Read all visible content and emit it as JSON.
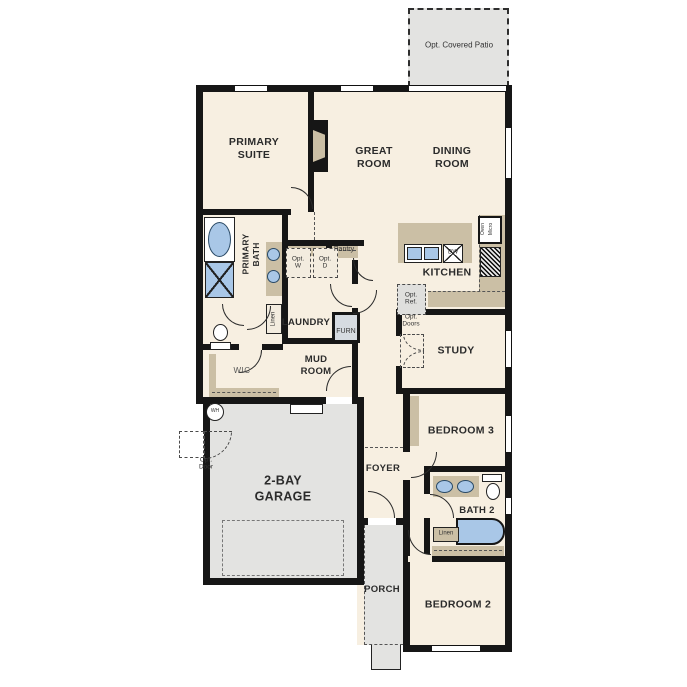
{
  "plan_title": "Single-story floor plan",
  "colors": {
    "floor": "#f7efe1",
    "concrete": "#e3e3e1",
    "cabinet": "#cbbfa5",
    "fixture_blue": "#a9c7e7",
    "wall": "#161616"
  },
  "rooms": {
    "patio": "Opt. Covered Patio",
    "primary_suite": "PRIMARY\nSUITE",
    "great_room": "GREAT\nROOM",
    "dining_room": "DINING\nROOM",
    "primary_bath": "PRIMARY\nBATH",
    "kitchen": "KITCHEN",
    "laundry": "LAUNDRY",
    "mud_room": "MUD\nROOM",
    "wic": "WIC",
    "study": "STUDY",
    "foyer": "FOYER",
    "bedroom3": "BEDROOM 3",
    "bath2": "BATH 2",
    "bedroom2": "BEDROOM 2",
    "garage": "2-BAY\nGARAGE",
    "porch": "PORCH"
  },
  "fixtures": {
    "pantry": "Pantry",
    "furnace": "FURN",
    "linen_primary": "Linen",
    "linen_bath2": "Linen",
    "opt_washer": "Opt.\nW",
    "opt_dryer": "Opt.\nD",
    "opt_ref": "Opt.\nRef.",
    "opt_doors": "Opt.\nDoors",
    "opt_door": "Opt.\nDoor",
    "oven": "Oven",
    "micro": "Micro",
    "dishwasher": "DW",
    "water_heater": "WH"
  }
}
